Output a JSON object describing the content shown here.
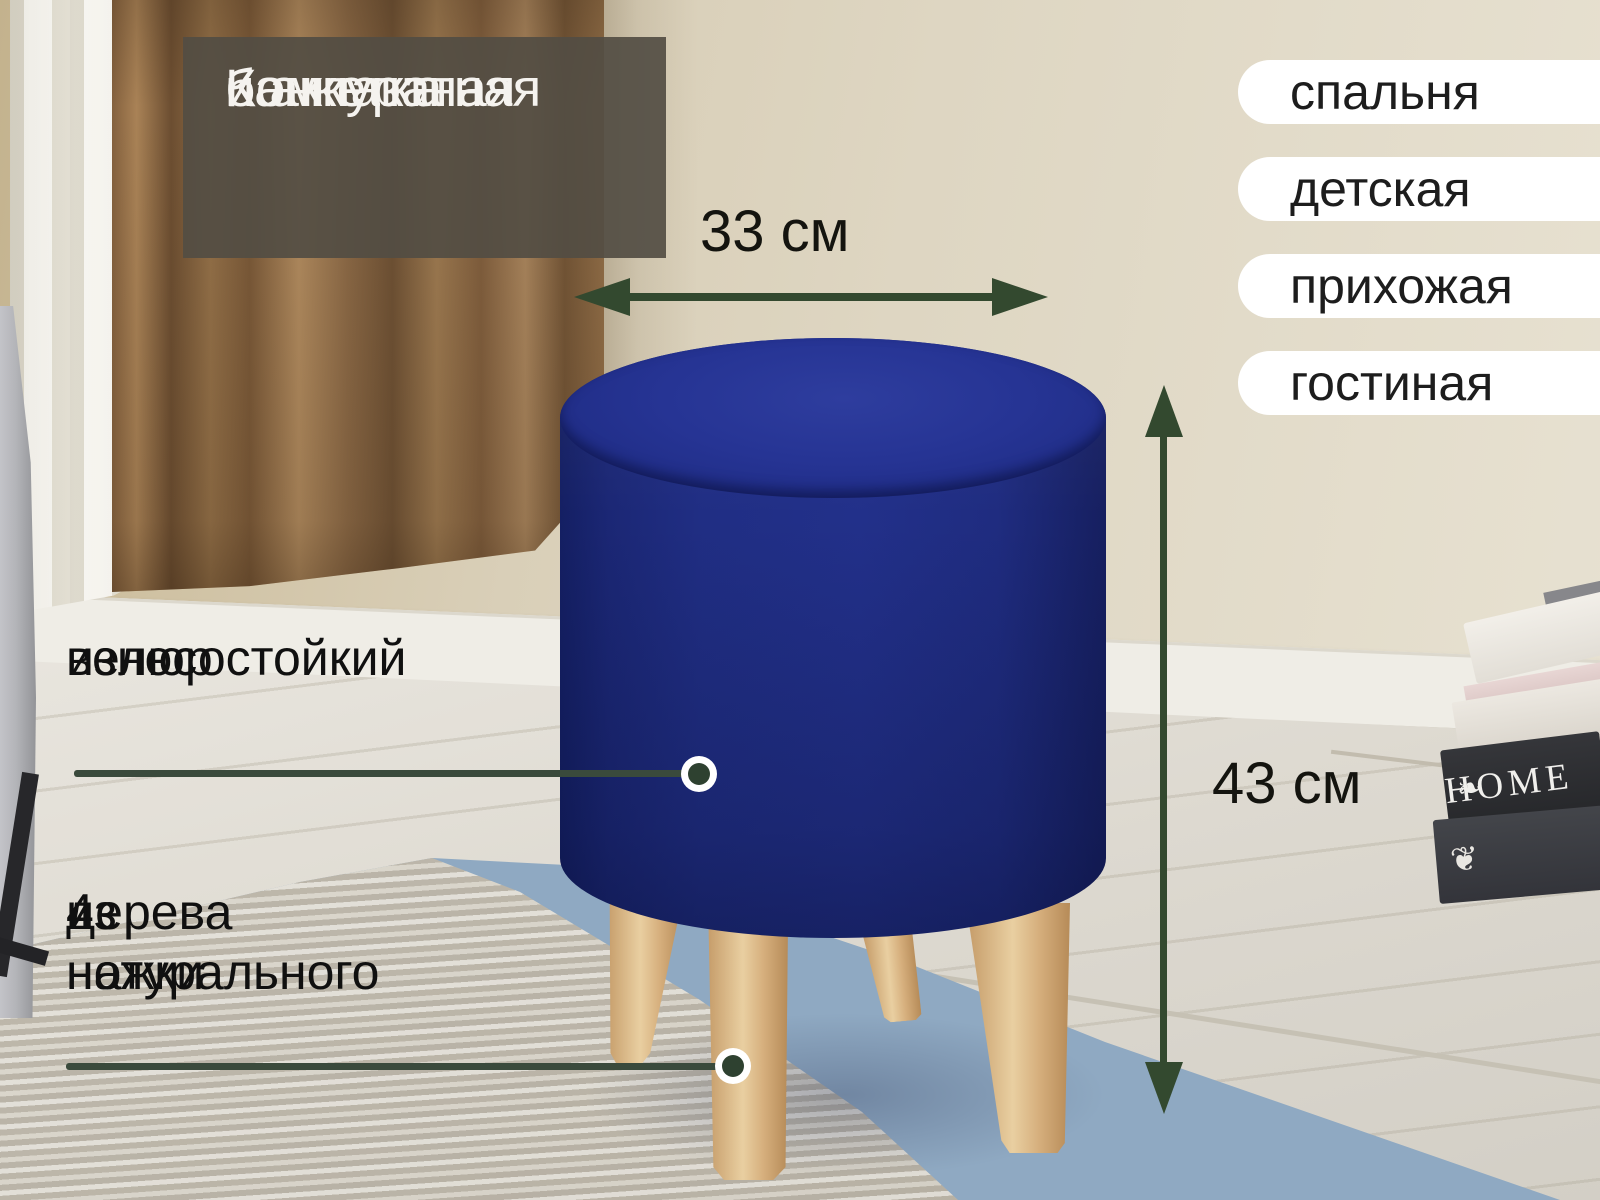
{
  "title": {
    "lines": [
      "Компактная",
      "и аккуратная",
      "банкетка"
    ]
  },
  "room_tags": [
    "спальня",
    "детская",
    "прихожая",
    "гостиная"
  ],
  "dimensions": {
    "width": "33 см",
    "height": "43 см"
  },
  "features": {
    "fabric": {
      "lines": [
        "износостойкий",
        "велюр"
      ]
    },
    "legs": {
      "lines": [
        "4 ножки",
        "из натурального",
        "дерева"
      ]
    }
  },
  "photo": {
    "book_spine": "HOME",
    "book_ornament": "❧",
    "book_ornament_2": "❦"
  },
  "colors": {
    "accent_green": "#33492f",
    "ottoman_navy": "#202e86",
    "leg_wood": "#d9b486",
    "overlay_bg": "#524d43",
    "pill_bg": "#ffffff",
    "rug_blue": "#8fa9c2",
    "wall_beige": "#dcd3be",
    "text_dark": "#141414",
    "text_light": "#f5f3ef"
  }
}
